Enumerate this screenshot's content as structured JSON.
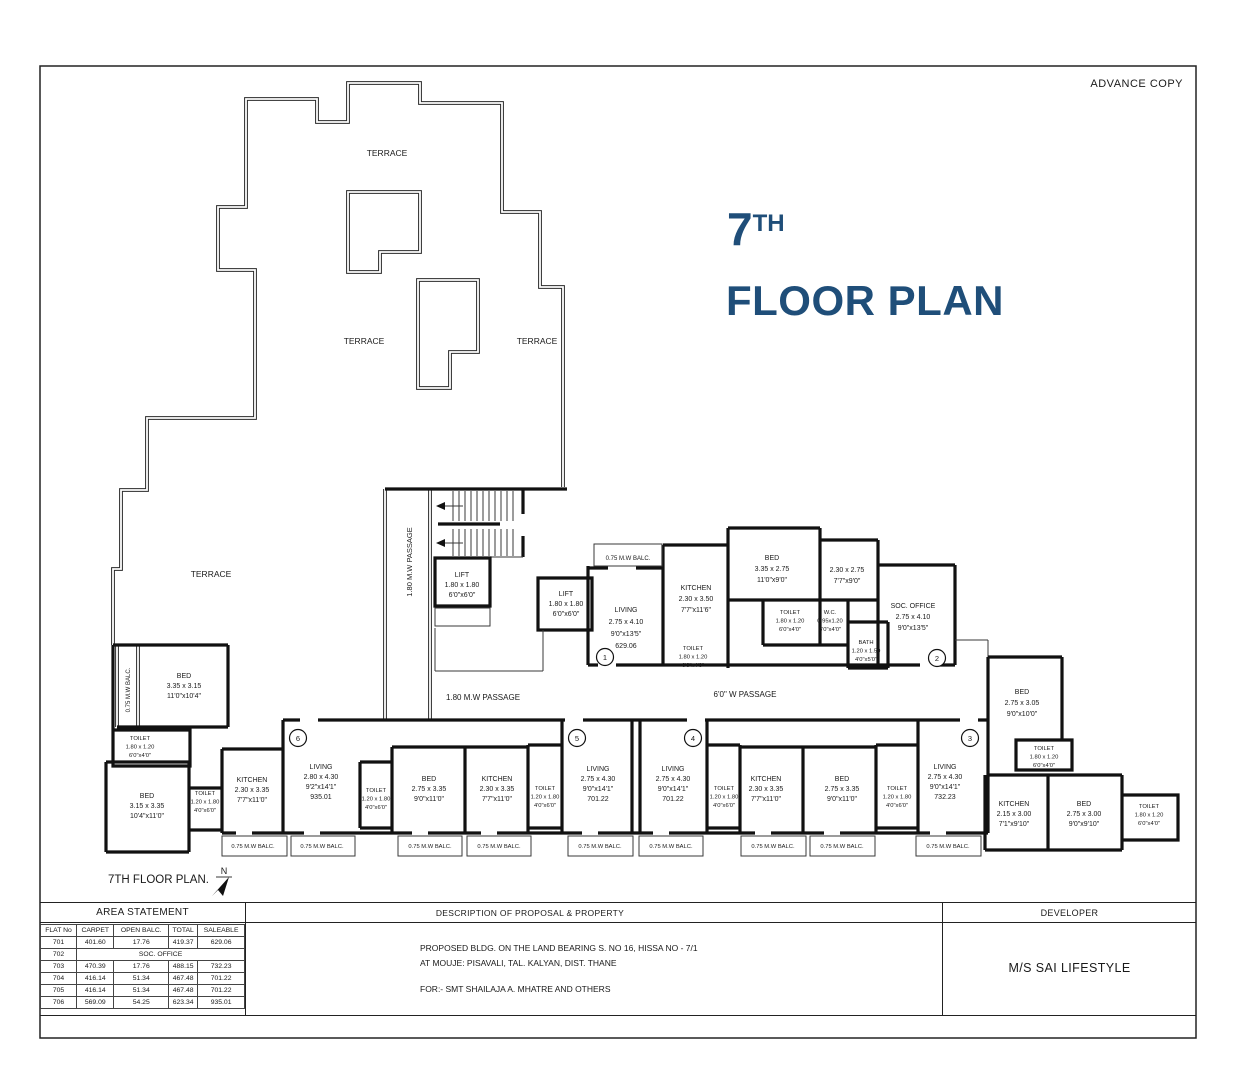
{
  "sheet": {
    "advance_copy": "ADVANCE COPY",
    "title_num": "7",
    "title_sup": "TH",
    "title_rest": "FLOOR PLAN",
    "plan_caption": "7TH FLOOR PLAN.",
    "accent_color": "#1F4E79",
    "line_color": "#1a1a1a"
  },
  "plan": {
    "labels": [
      {
        "name": "terrace-label",
        "x": 387,
        "y": 156,
        "fs": 8.5,
        "lines": [
          "TERRACE"
        ]
      },
      {
        "name": "terrace-label",
        "x": 364,
        "y": 344,
        "fs": 8.5,
        "lines": [
          "TERRACE"
        ]
      },
      {
        "name": "terrace-label",
        "x": 537,
        "y": 344,
        "fs": 8.5,
        "lines": [
          "TERRACE"
        ]
      },
      {
        "name": "terrace-label",
        "x": 211,
        "y": 577,
        "fs": 8.5,
        "lines": [
          "TERRACE"
        ]
      },
      {
        "name": "passage-label",
        "x": 412,
        "y": 562,
        "fs": 7.5,
        "rot": -90,
        "lines": [
          "1.80 M.W PASSAGE"
        ]
      },
      {
        "name": "passage-label",
        "x": 483,
        "y": 700,
        "fs": 8,
        "lines": [
          "1.80 M.W PASSAGE"
        ]
      },
      {
        "name": "passage-label",
        "x": 745,
        "y": 697,
        "fs": 8,
        "lines": [
          "6'0\" W PASSAGE"
        ]
      },
      {
        "name": "balcony-label",
        "x": 130,
        "y": 690,
        "fs": 6,
        "rot": -90,
        "lines": [
          "0.75 M.W BALC."
        ]
      },
      {
        "name": "lift-label",
        "x": 462,
        "y": 577,
        "fs": 7,
        "lh": 10,
        "lines": [
          "LIFT",
          "1.80 x 1.80",
          "6'0\"x6'0\""
        ]
      },
      {
        "name": "lift-label",
        "x": 566,
        "y": 596,
        "fs": 7,
        "lh": 10,
        "lines": [
          "LIFT",
          "1.80 x 1.80",
          "6'0\"x6'0\""
        ]
      },
      {
        "name": "balcony-label",
        "x": 628,
        "y": 560,
        "fs": 6,
        "lines": [
          "0.75 M.W BALC."
        ]
      },
      {
        "name": "room-label-living-701",
        "x": 626,
        "y": 612,
        "fs": 7,
        "lh": 12,
        "lines": [
          "LIVING",
          "2.75 x 4.10",
          "9'0\"x13'5\"",
          "629.06"
        ]
      },
      {
        "name": "room-label-kitchen-701",
        "x": 696,
        "y": 590,
        "fs": 7,
        "lh": 11,
        "lines": [
          "KITCHEN",
          "2.30 x 3.50",
          "7'7\"x11'6\""
        ]
      },
      {
        "name": "room-label-bed-701",
        "x": 772,
        "y": 560,
        "fs": 7,
        "lh": 11,
        "lines": [
          "BED",
          "3.35 x 2.75",
          "11'0\"x9'0\""
        ]
      },
      {
        "name": "room-label-room-702",
        "x": 847,
        "y": 572,
        "fs": 7,
        "lh": 11,
        "lines": [
          "2.30 x 2.75",
          "7'7\"x9'0\""
        ]
      },
      {
        "name": "room-label-toilet",
        "x": 790,
        "y": 614,
        "fs": 5.8,
        "lh": 8.5,
        "lines": [
          "TOILET",
          "1.80 x 1.20",
          "6'0\"x4'0\""
        ]
      },
      {
        "name": "room-label-wc",
        "x": 830,
        "y": 614,
        "fs": 5.8,
        "lh": 8.5,
        "lines": [
          "W.C.",
          "0.95x1.20",
          "3'0\"x4'0\""
        ]
      },
      {
        "name": "room-label-bath",
        "x": 866,
        "y": 644,
        "fs": 5.8,
        "lh": 8.5,
        "lines": [
          "BATH",
          "1.20 x 1.50",
          "4'0\"x5'0\""
        ]
      },
      {
        "name": "room-label-toilet",
        "x": 693,
        "y": 650,
        "fs": 5.8,
        "lh": 8.5,
        "lines": [
          "TOILET",
          "1.80 x 1.20",
          "6'0\"x4'0\""
        ]
      },
      {
        "name": "room-label-soc-office",
        "x": 913,
        "y": 608,
        "fs": 7,
        "lh": 11,
        "lines": [
          "SOC. OFFICE",
          "2.75 x 4.10",
          "9'0\"x13'5\""
        ]
      },
      {
        "name": "room-label-bed-703",
        "x": 1022,
        "y": 694,
        "fs": 7,
        "lh": 11,
        "lines": [
          "BED",
          "2.75 x 3.05",
          "9'0\"x10'0\""
        ]
      },
      {
        "name": "room-label-toilet",
        "x": 1044,
        "y": 750,
        "fs": 5.8,
        "lh": 8.5,
        "lines": [
          "TOILET",
          "1.80 x 1.20",
          "6'0\"x4'0\""
        ]
      },
      {
        "name": "room-label-kitchen-703",
        "x": 1014,
        "y": 806,
        "fs": 7,
        "lh": 10,
        "lines": [
          "KITCHEN",
          "2.15 x 3.00",
          "7'1\"x9'10\""
        ]
      },
      {
        "name": "room-label-bed-703b",
        "x": 1084,
        "y": 806,
        "fs": 7,
        "lh": 10,
        "lines": [
          "BED",
          "2.75 x 3.00",
          "9'0\"x9'10\""
        ]
      },
      {
        "name": "room-label-toilet",
        "x": 1149,
        "y": 808,
        "fs": 5.8,
        "lh": 8.5,
        "lines": [
          "TOILET",
          "1.80 x 1.20",
          "6'0\"x4'0\""
        ]
      },
      {
        "name": "room-label-bed-706",
        "x": 184,
        "y": 678,
        "fs": 7,
        "lh": 10,
        "lines": [
          "BED",
          "3.35 x 3.15",
          "11'0\"x10'4\""
        ]
      },
      {
        "name": "room-label-toilet",
        "x": 140,
        "y": 740,
        "fs": 5.8,
        "lh": 8.5,
        "lines": [
          "TOILET",
          "1.80 x 1.20",
          "6'0\"x4'0\""
        ]
      },
      {
        "name": "room-label-bed-706b",
        "x": 147,
        "y": 798,
        "fs": 7,
        "lh": 10,
        "lines": [
          "BED",
          "3.15 x 3.35",
          "10'4\"x11'0\""
        ]
      },
      {
        "name": "room-label-toilet",
        "x": 205,
        "y": 795,
        "fs": 5.8,
        "lh": 8.5,
        "lines": [
          "TOILET",
          "1.20 x 1.80",
          "4'0\"x6'0\""
        ]
      },
      {
        "name": "room-label-kitchen-706",
        "x": 252,
        "y": 782,
        "fs": 7,
        "lh": 10,
        "lines": [
          "KITCHEN",
          "2.30 x 3.35",
          "7'7\"x11'0\""
        ]
      },
      {
        "name": "room-label-living-706",
        "x": 321,
        "y": 769,
        "fs": 7,
        "lh": 10,
        "lines": [
          "LIVING",
          "2.80 x 4.30",
          "9'2\"x14'1\"",
          "935.01"
        ]
      },
      {
        "name": "room-label-toilet",
        "x": 376,
        "y": 792,
        "fs": 5.8,
        "lh": 8.5,
        "lines": [
          "TOILET",
          "1.20 x 1.80",
          "4'0\"x6'0\""
        ]
      },
      {
        "name": "room-label-bed-705",
        "x": 429,
        "y": 781,
        "fs": 7,
        "lh": 10,
        "lines": [
          "BED",
          "2.75 x 3.35",
          "9'0\"x11'0\""
        ]
      },
      {
        "name": "room-label-kitchen-705",
        "x": 497,
        "y": 781,
        "fs": 7,
        "lh": 10,
        "lines": [
          "KITCHEN",
          "2.30 x 3.35",
          "7'7\"x11'0\""
        ]
      },
      {
        "name": "room-label-toilet",
        "x": 545,
        "y": 790,
        "fs": 5.8,
        "lh": 8.5,
        "lines": [
          "TOILET",
          "1.20 x 1.80",
          "4'0\"x6'0\""
        ]
      },
      {
        "name": "room-label-living-705",
        "x": 598,
        "y": 771,
        "fs": 7,
        "lh": 10,
        "lines": [
          "LIVING",
          "2.75 x 4.30",
          "9'0\"x14'1\"",
          "701.22"
        ]
      },
      {
        "name": "room-label-living-704",
        "x": 673,
        "y": 771,
        "fs": 7,
        "lh": 10,
        "lines": [
          "LIVING",
          "2.75 x 4.30",
          "9'0\"x14'1\"",
          "701.22"
        ]
      },
      {
        "name": "room-label-toilet",
        "x": 724,
        "y": 790,
        "fs": 5.8,
        "lh": 8.5,
        "lines": [
          "TOILET",
          "1.20 x 1.80",
          "4'0\"x6'0\""
        ]
      },
      {
        "name": "room-label-kitchen-704",
        "x": 766,
        "y": 781,
        "fs": 7,
        "lh": 10,
        "lines": [
          "KITCHEN",
          "2.30 x 3.35",
          "7'7\"x11'0\""
        ]
      },
      {
        "name": "room-label-bed-704",
        "x": 842,
        "y": 781,
        "fs": 7,
        "lh": 10,
        "lines": [
          "BED",
          "2.75 x 3.35",
          "9'0\"x11'0\""
        ]
      },
      {
        "name": "room-label-toilet",
        "x": 897,
        "y": 790,
        "fs": 5.8,
        "lh": 8.5,
        "lines": [
          "TOILET",
          "1.20 x 1.80",
          "4'0\"x6'0\""
        ]
      },
      {
        "name": "room-label-living-703",
        "x": 945,
        "y": 769,
        "fs": 7,
        "lh": 10,
        "lines": [
          "LIVING",
          "2.75 x 4.30",
          "9'0\"x14'1\"",
          "732.23"
        ]
      },
      {
        "name": "balcony-label",
        "x": 253,
        "y": 848,
        "fs": 5.8,
        "lines": [
          "0.75 M.W BALC."
        ]
      },
      {
        "name": "balcony-label",
        "x": 322,
        "y": 848,
        "fs": 5.8,
        "lines": [
          "0.75 M.W BALC."
        ]
      },
      {
        "name": "balcony-label",
        "x": 430,
        "y": 848,
        "fs": 5.8,
        "lines": [
          "0.75 M.W BALC."
        ]
      },
      {
        "name": "balcony-label",
        "x": 499,
        "y": 848,
        "fs": 5.8,
        "lines": [
          "0.75 M.W BALC."
        ]
      },
      {
        "name": "balcony-label",
        "x": 600,
        "y": 848,
        "fs": 5.8,
        "lines": [
          "0.75 M.W BALC."
        ]
      },
      {
        "name": "balcony-label",
        "x": 671,
        "y": 848,
        "fs": 5.8,
        "lines": [
          "0.75 M.W BALC."
        ]
      },
      {
        "name": "balcony-label",
        "x": 773,
        "y": 848,
        "fs": 5.8,
        "lines": [
          "0.75 M.W BALC."
        ]
      },
      {
        "name": "balcony-label",
        "x": 842,
        "y": 848,
        "fs": 5.8,
        "lines": [
          "0.75 M.W BALC."
        ]
      },
      {
        "name": "balcony-label",
        "x": 948,
        "y": 848,
        "fs": 5.8,
        "lines": [
          "0.75 M.W BALC."
        ]
      },
      {
        "name": "north-label",
        "x": 224,
        "y": 874,
        "fs": 9,
        "lines": [
          "N"
        ]
      }
    ],
    "unit_markers": [
      {
        "n": "1",
        "x": 605,
        "y": 657
      },
      {
        "n": "2",
        "x": 937,
        "y": 658
      },
      {
        "n": "3",
        "x": 970,
        "y": 738
      },
      {
        "n": "4",
        "x": 693,
        "y": 738
      },
      {
        "n": "5",
        "x": 577,
        "y": 738
      },
      {
        "n": "6",
        "x": 298,
        "y": 738
      }
    ]
  },
  "area_statement": {
    "title": "AREA STATEMENT",
    "columns": [
      "FLAT No",
      "CARPET",
      "OPEN BALC.",
      "TOTAL",
      "SALEABLE"
    ],
    "rows": [
      {
        "cells": [
          "701",
          "401.60",
          "17.76",
          "419.37",
          "629.06"
        ]
      },
      {
        "cells": [
          "702",
          "SOC. OFFICE"
        ],
        "span": 4
      },
      {
        "cells": [
          "703",
          "470.39",
          "17.76",
          "488.15",
          "732.23"
        ]
      },
      {
        "cells": [
          "704",
          "416.14",
          "51.34",
          "467.48",
          "701.22"
        ]
      },
      {
        "cells": [
          "705",
          "416.14",
          "51.34",
          "467.48",
          "701.22"
        ]
      },
      {
        "cells": [
          "706",
          "569.09",
          "54.25",
          "623.34",
          "935.01"
        ]
      }
    ]
  },
  "description": {
    "title": "DESCRIPTION OF PROPOSAL & PROPERTY",
    "lines": [
      "PROPOSED BLDG. ON THE LAND BEARING  S. NO 16, HISSA NO - 7/1",
      "AT MOUJE: PISAVALI,  TAL. KALYAN, DIST. THANE",
      "FOR:- SMT SHAILAJA A. MHATRE AND OTHERS"
    ]
  },
  "developer": {
    "title": "DEVELOPER",
    "name": "M/S SAI LIFESTYLE"
  }
}
